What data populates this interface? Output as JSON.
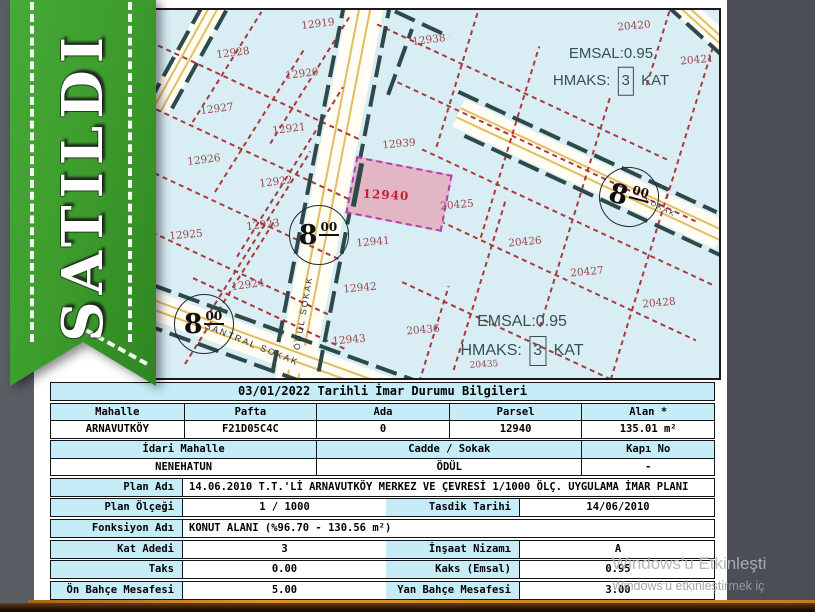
{
  "ribbon": {
    "label": "SATILDI"
  },
  "palette": {
    "ribbon_green": "#3b9a2b",
    "table_header_cyan": "#c6edf7",
    "map_parcel_blue": "#d9edf4",
    "highlight_pink": "#e3b6c6",
    "highlight_border_magenta": "#b13fb1",
    "parcel_boundary_red": "#ab3a3a",
    "setback_teal": "#2e4949",
    "road_center_yellow": "#e2bd62"
  },
  "map": {
    "parcels": [
      {
        "id": "12919",
        "x": 316,
        "y": 22,
        "r": -7
      },
      {
        "id": "12928",
        "x": 231,
        "y": 51,
        "r": -7
      },
      {
        "id": "12920",
        "x": 300,
        "y": 72,
        "r": -7
      },
      {
        "id": "12938",
        "x": 427,
        "y": 38,
        "r": -7
      },
      {
        "id": "12927",
        "x": 215,
        "y": 107,
        "r": -7
      },
      {
        "id": "12921",
        "x": 287,
        "y": 127,
        "r": -7
      },
      {
        "id": "12939",
        "x": 397,
        "y": 142,
        "r": -5
      },
      {
        "id": "12926",
        "x": 202,
        "y": 158,
        "r": -7
      },
      {
        "id": "12922",
        "x": 274,
        "y": 180,
        "r": -7
      },
      {
        "id": "12925",
        "x": 184,
        "y": 233,
        "r": -5
      },
      {
        "id": "12923",
        "x": 261,
        "y": 223,
        "r": -7
      },
      {
        "id": "12940",
        "x": 384,
        "y": 193,
        "r": 3,
        "hl": true
      },
      {
        "id": "20425",
        "x": 455,
        "y": 203,
        "r": -5
      },
      {
        "id": "12941",
        "x": 371,
        "y": 240,
        "r": -5
      },
      {
        "id": "20426",
        "x": 523,
        "y": 240,
        "r": -5
      },
      {
        "id": "12924",
        "x": 246,
        "y": 283,
        "r": -7
      },
      {
        "id": "12942",
        "x": 358,
        "y": 286,
        "r": -5
      },
      {
        "id": "20427",
        "x": 585,
        "y": 270,
        "r": -5
      },
      {
        "id": "20428",
        "x": 657,
        "y": 301,
        "r": -5
      },
      {
        "id": "12943",
        "x": 347,
        "y": 338,
        "r": -5
      },
      {
        "id": "20436",
        "x": 421,
        "y": 328,
        "r": -5
      },
      {
        "id": "20420",
        "x": 632,
        "y": 24,
        "r": -5
      },
      {
        "id": "20421",
        "x": 695,
        "y": 58,
        "r": -5
      },
      {
        "id": "20435",
        "x": 482,
        "y": 363,
        "r": -3,
        "s": 9
      }
    ],
    "zones": [
      {
        "emsal": "EMSAL:0.95",
        "hmaks_label": "HMAKS:",
        "kat": "3",
        "kat_suffix": "KAT",
        "x": 609,
        "y": 66,
        "size": 15
      },
      {
        "emsal": "EMSAL:0.95",
        "hmaks_label": "HMAKS:",
        "kat": "3",
        "kat_suffix": "KAT",
        "x": 520,
        "y": 335,
        "size": 16
      }
    ],
    "road_markers": [
      {
        "main": "8",
        "sup": "00",
        "x": 316,
        "y": 232,
        "r": 0
      },
      {
        "main": "8",
        "sup": "00",
        "x": 201,
        "y": 321,
        "r": 0
      },
      {
        "main": "8",
        "sup": "00",
        "x": 626,
        "y": 194,
        "r": 15
      }
    ],
    "streets": [
      {
        "name": "ÖDÜL SOKAK",
        "x": 301,
        "y": 311,
        "r": -80,
        "size": 8.5
      },
      {
        "name": "SANTRAL SOKAK",
        "x": 250,
        "y": 342,
        "r": 22,
        "size": 9
      },
      {
        "name": "SOKAK",
        "x": 658,
        "y": 206,
        "r": 26,
        "size": 7
      }
    ]
  },
  "table": {
    "title": "03/01/2022 Tarihli İmar Durumu Bilgileri",
    "identity": {
      "headers": [
        "Mahalle",
        "Pafta",
        "Ada",
        "Parsel",
        "Alan *"
      ],
      "values": [
        "ARNAVUTKÖY",
        "F21D05C4C",
        "0",
        "12940",
        "135.01 m²"
      ]
    },
    "address": {
      "headers": [
        "İdari Mahalle",
        "Cadde / Sokak",
        "Kapı No"
      ],
      "values": [
        "NENEHATUN",
        "ÖDÜL",
        "-"
      ]
    },
    "details": [
      {
        "label": "Plan Adı",
        "value": "14.06.2010 T.T.'Lİ ARNAVUTKÖY MERKEZ VE ÇEVRESİ 1/1000 ÖLÇ. UYGULAMA İMAR PLANI",
        "full": true
      },
      {
        "label": "Plan Ölçeği",
        "value": "1 / 1000",
        "label2": "Tasdik Tarihi",
        "value2": "14/06/2010"
      },
      {
        "label": "Fonksiyon Adı",
        "value": "KONUT ALANI  (%96.70 - 130.56 m²)",
        "full": true
      },
      {
        "label": "Kat Adedi",
        "value": "3",
        "label2": "İnşaat Nizamı",
        "value2": "A"
      },
      {
        "label": "Taks",
        "value": "0.00",
        "label2": "Kaks (Emsal)",
        "value2": "0.95"
      },
      {
        "label": "Ön Bahçe Mesafesi",
        "value": "5.00",
        "label2": "Yan Bahçe Mesafesi",
        "value2": "3.00"
      }
    ]
  },
  "watermark": {
    "line1": "Windows'u Etkinleşti",
    "line2": "Windows'u etkinleştirmek iç"
  }
}
